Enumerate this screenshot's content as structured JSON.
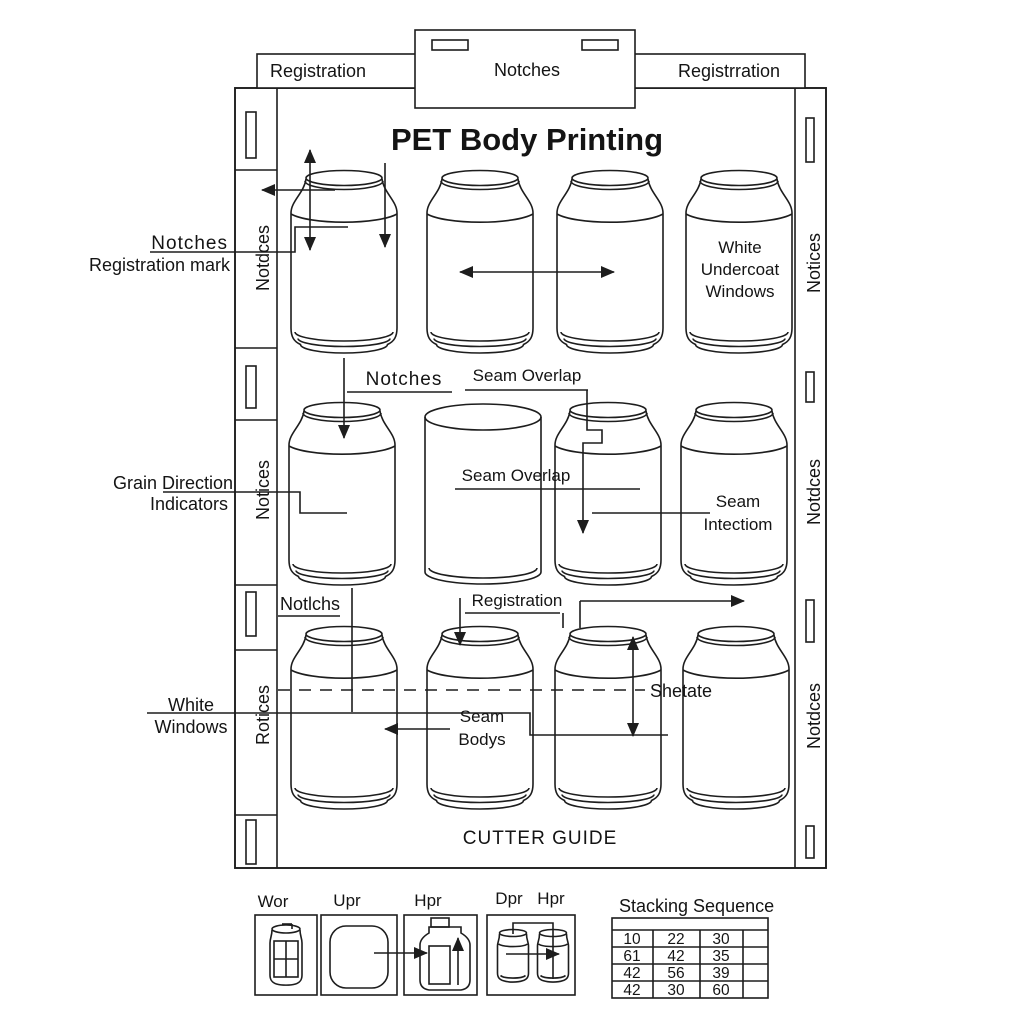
{
  "title": "PET Body Printing",
  "header": {
    "left": "Registration",
    "center": "Notches",
    "right": "Registrration"
  },
  "side_labels": {
    "left_top": "Notdces",
    "left_mid": "Notices",
    "left_bottom": "Rotices",
    "right_top": "Notices",
    "right_mid": "Notdces",
    "right_bottom": "Notdces"
  },
  "row1": {
    "left_label_1": "Notches",
    "left_label_2": "Registration mark",
    "can4_1": "White",
    "can4_2": "Undercoat",
    "can4_3": "Windows"
  },
  "row2": {
    "notches": "Notches",
    "seam_overlap_top": "Seam Overlap",
    "seam_overlap_mid": "Seam Overlap",
    "left_label_1": "Grain Direction",
    "left_label_2": "Indicators",
    "can4_1": "Seam",
    "can4_2": "Intectiom"
  },
  "row3": {
    "notches": "Notlchs",
    "registration": "Registration",
    "shetate": "Shetate",
    "left_label_1": "White",
    "left_label_2": "Windows",
    "seam_1": "Seam",
    "seam_2": "Bodys"
  },
  "footer": {
    "cutter_guide": "CUTTER GUIDE"
  },
  "legend": {
    "items": [
      "Wor",
      "Upr",
      "Hpr",
      "Dpr",
      "Hpr"
    ]
  },
  "stacking": {
    "title": "Stacking Sequence",
    "rows": [
      [
        "10",
        "22",
        "30"
      ],
      [
        "61",
        "42",
        "35"
      ],
      [
        "42",
        "56",
        "39"
      ],
      [
        "42",
        "30",
        "60"
      ]
    ]
  },
  "colors": {
    "ink": "#1d1d1d",
    "background": "#ffffff"
  }
}
